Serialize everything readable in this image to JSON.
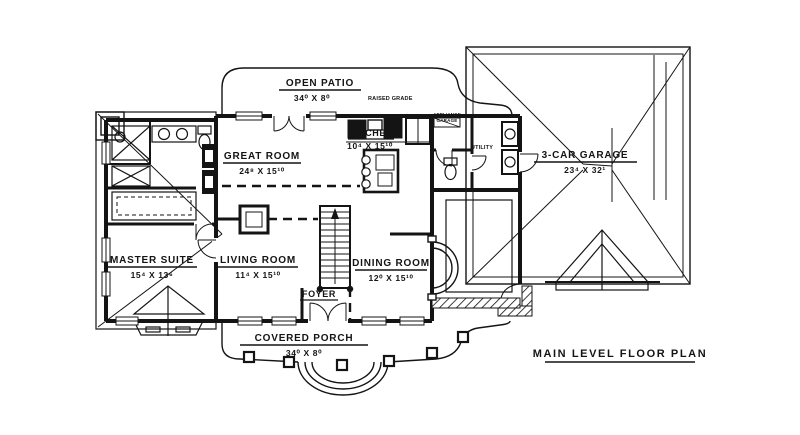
{
  "drawing_title": "MAIN LEVEL FLOOR PLAN",
  "rooms": {
    "open_patio": {
      "name": "OPEN PATIO",
      "dims": "34⁰ X 8⁰",
      "note": "RAISED GRADE"
    },
    "great_room": {
      "name": "GREAT ROOM",
      "dims": "24⁸ X 15¹⁰"
    },
    "kitchen": {
      "name": "KITCHEN",
      "dims": "10⁴ X 15¹⁰"
    },
    "appliance_garage": {
      "line1": "APPLIANCE",
      "line2": "GARAGE"
    },
    "utility": {
      "name": "UTILITY"
    },
    "garage": {
      "name": "3-CAR GARAGE",
      "dims": "23⁴ X 32¹"
    },
    "master_suite": {
      "name": "MASTER SUITE",
      "dims": "15⁴ X 13⁶"
    },
    "living_room": {
      "name": "LIVING ROOM",
      "dims": "11⁴ X 15¹⁰"
    },
    "dining_room": {
      "name": "DINING ROOM",
      "dims": "12⁰ X 15¹⁰"
    },
    "foyer": {
      "name": "FOYER"
    },
    "covered_porch": {
      "name": "COVERED PORCH",
      "dims": "34⁰ X 8⁰"
    }
  },
  "colors": {
    "ink": "#141414",
    "paper": "#ffffff"
  }
}
